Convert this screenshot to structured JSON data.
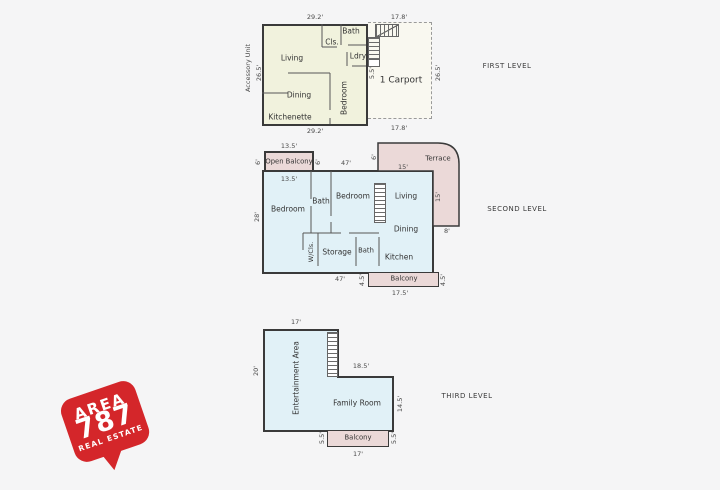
{
  "branding": {
    "word_top": "AREA",
    "number": "787",
    "word_bottom": "REAL ESTATE",
    "color": "#d4262a"
  },
  "colors": {
    "wall": "#3a3a3a",
    "unit_fill": "#f1f2dd",
    "blue_fill": "#e1f1f7",
    "pink_fill": "#ebd9d8",
    "carport_fill": "#f9f8f0"
  },
  "levels": {
    "first": {
      "label": "FIRST LEVEL",
      "side_label": "Accessory Unit",
      "rooms": {
        "living": "Living",
        "closet": "Cls.",
        "bath": "Bath",
        "laundry": "Ldry",
        "dining": "Dining",
        "bedroom": "Bedroom",
        "kitchenette": "Kitchenette",
        "carport": "1 Carport"
      },
      "dims": {
        "top_left": "29.2'",
        "top_right": "17.8'",
        "bottom_left": "29.2'",
        "bottom_right": "17.8'",
        "left": "26.5'",
        "right": "26.5'",
        "stair": "5.5'"
      }
    },
    "second": {
      "label": "SECOND LEVEL",
      "rooms": {
        "open_balcony": "Open Balcony",
        "bedroom_left": "Bedroom",
        "bath_top": "Bath",
        "bedroom_mid": "Bedroom",
        "living": "Living",
        "dining": "Dining",
        "wcloset": "W/Cls.",
        "storage": "Storage",
        "bath_bottom": "Bath",
        "kitchen": "Kitchen",
        "terrace": "Terrace",
        "balcony": "Balcony"
      },
      "dims": {
        "open_balcony_top": "13.5'",
        "open_balcony_left": "6'",
        "open_balcony_right": "6'",
        "inner_top": "13.5'",
        "top": "47'",
        "terrace_left": "6'",
        "terrace_top": "15'",
        "terrace_right": "15'",
        "terrace_bottom": "8'",
        "left": "28'",
        "bottom": "47'",
        "balcony_left": "4.5'",
        "balcony_right": "4.5'",
        "balcony_bottom": "17.5'"
      }
    },
    "third": {
      "label": "THIRD LEVEL",
      "rooms": {
        "entertainment": "Entertainment Area",
        "family": "Family Room",
        "balcony": "Balcony"
      },
      "dims": {
        "top": "17'",
        "left": "20'",
        "mid": "18.5'",
        "right": "14.5'",
        "balcony_left": "5.5'",
        "balcony_right": "5.5'",
        "balcony_bottom": "17'"
      }
    }
  }
}
